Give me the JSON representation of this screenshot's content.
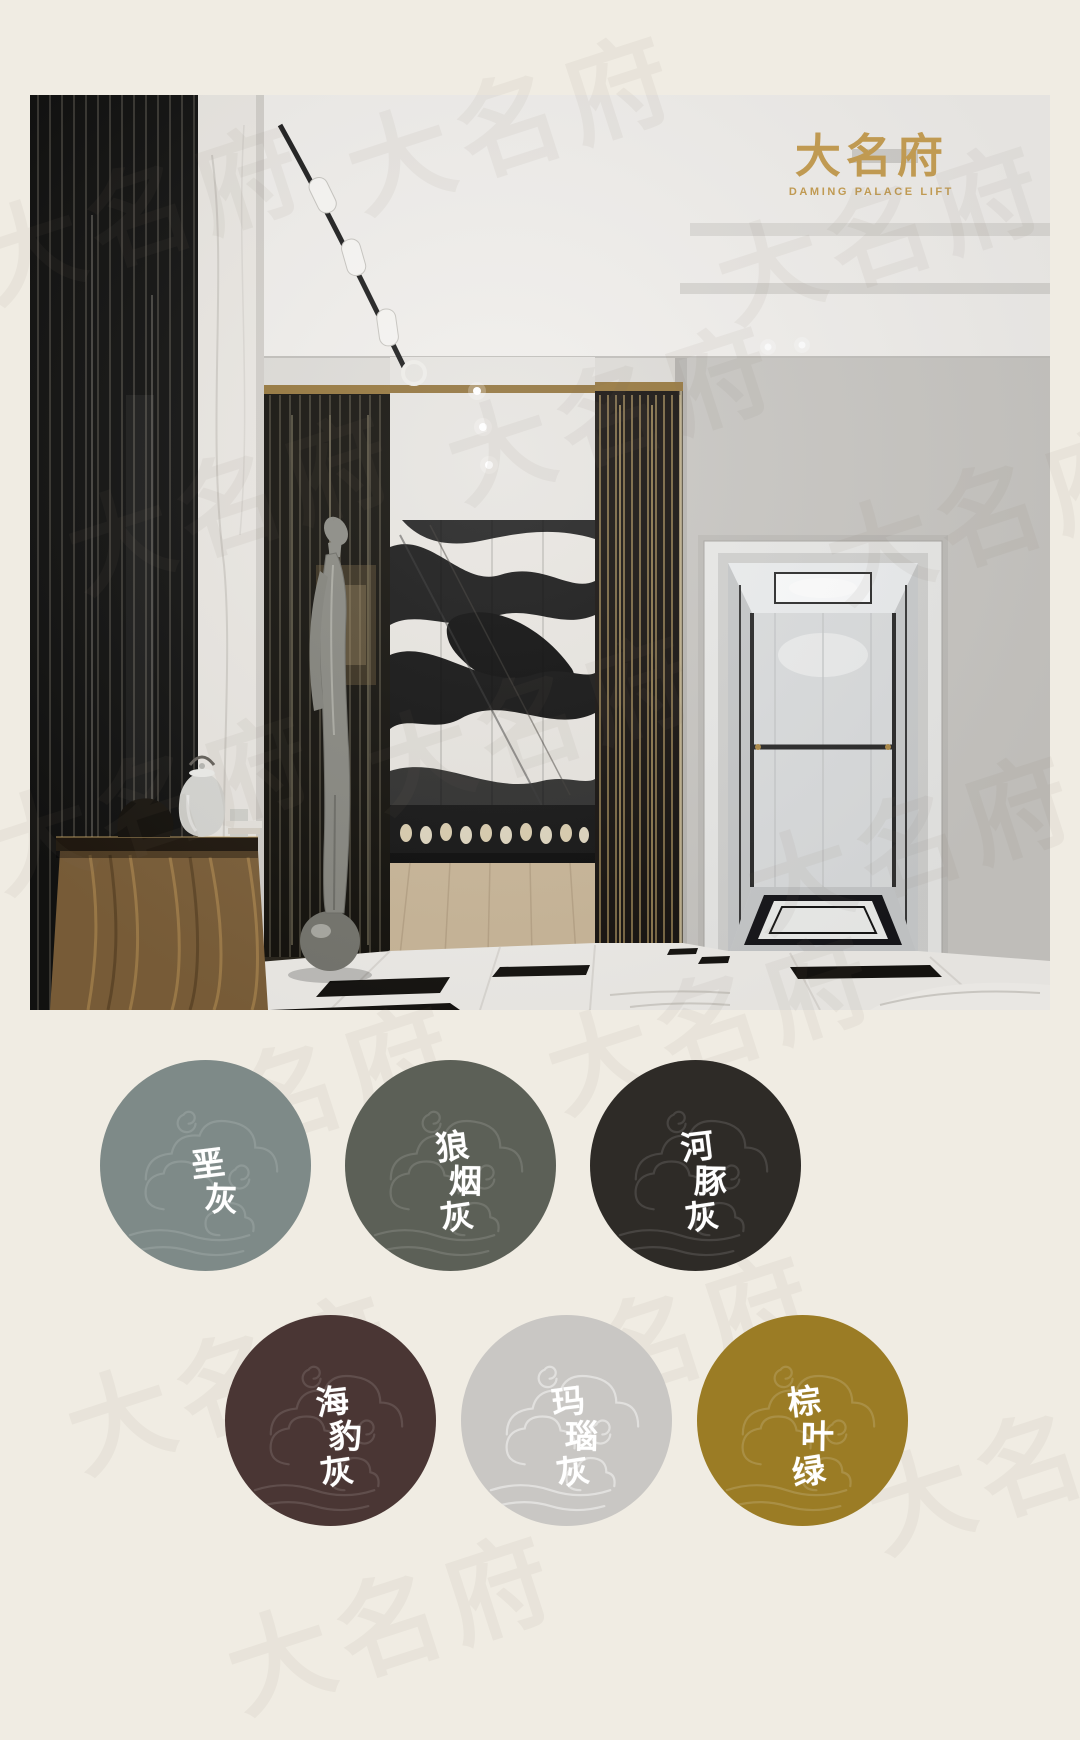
{
  "page": {
    "background": "#f0ece3"
  },
  "brand": {
    "logo_cn": "大名府",
    "logo_en": "DAMING PALACE LIFT",
    "logo_color": "#c09a52",
    "watermark": "大名府"
  },
  "palette": {
    "label_color": "#ffffff",
    "swatches": [
      {
        "name": "垩灰",
        "chars": [
          "垩",
          "灰"
        ],
        "color": "#7e8a88"
      },
      {
        "name": "狼烟灰",
        "chars": [
          "狼",
          "烟",
          "灰"
        ],
        "color": "#5c6057"
      },
      {
        "name": "河豚灰",
        "chars": [
          "河",
          "豚",
          "灰"
        ],
        "color": "#2e2b27"
      },
      {
        "name": "海豹灰",
        "chars": [
          "海",
          "豹",
          "灰"
        ],
        "color": "#4a3634"
      },
      {
        "name": "玛瑙灰",
        "chars": [
          "玛",
          "瑙",
          "灰"
        ],
        "color": "#c9c7c4"
      },
      {
        "name": "棕叶绿",
        "chars": [
          "棕",
          "叶",
          "绿"
        ],
        "color": "#9b7c25"
      }
    ]
  }
}
